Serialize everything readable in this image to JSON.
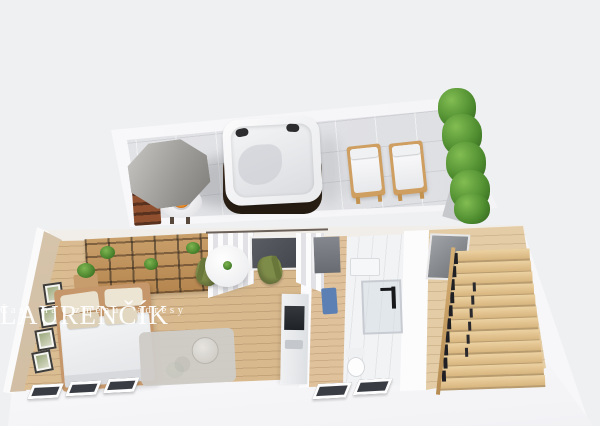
{
  "watermark": {
    "title": "LAURENČÍK",
    "subtitle": "Čas na změnu adresy"
  },
  "scene": {
    "description": "3D isometric floor-plan render of a studio apartment with roof terrace",
    "background_color": "#eff0f2",
    "terrace": {
      "floor_color": "#e0e1e4",
      "wall_color": "#f9f9fb",
      "items": [
        {
          "name": "storage-shelf",
          "color": "#90502f"
        },
        {
          "name": "patio-umbrella",
          "color": "#9a9893"
        },
        {
          "name": "fire-table",
          "flame_color": "#ef8c23"
        },
        {
          "name": "hot-tub",
          "shell_color": "#f5f5f6",
          "base_color": "#3a2b1e"
        },
        {
          "name": "sun-lounger",
          "count": 2,
          "wood_color": "#cf9f62",
          "cushion_color": "#f4f4f5"
        },
        {
          "name": "hedge",
          "color": "#4c8a2e"
        }
      ]
    },
    "apartment": {
      "left_wall_color": "#d9c8af",
      "wood_floor_color": "#d8b88c",
      "rooms": [
        {
          "name": "living-bedroom",
          "items": [
            "wall frames x4",
            "double bed",
            "bookshelf wall unit",
            "nightstand with plant",
            "area rug",
            "round coffee tables",
            "round dining table",
            "green chair x2",
            "curtains",
            "window",
            "kitchenette"
          ]
        },
        {
          "name": "hallway",
          "items": [
            "entry door",
            "blue runner mat"
          ]
        },
        {
          "name": "bathroom",
          "items": [
            "walk-in shower",
            "vanity",
            "toilet"
          ]
        },
        {
          "name": "stairwell",
          "items": [
            "wooden winder stairs",
            "black baluster railing",
            "glass door"
          ]
        }
      ],
      "facade_windows": {
        "left_group": 3,
        "middle_group": 2,
        "glass_color": "#393d43",
        "frame_color": "#fdfdfe"
      },
      "stair_wood_color": "#e0c28c",
      "chair_color": "#7e8c49",
      "mat_color": "#5d80b4"
    }
  }
}
